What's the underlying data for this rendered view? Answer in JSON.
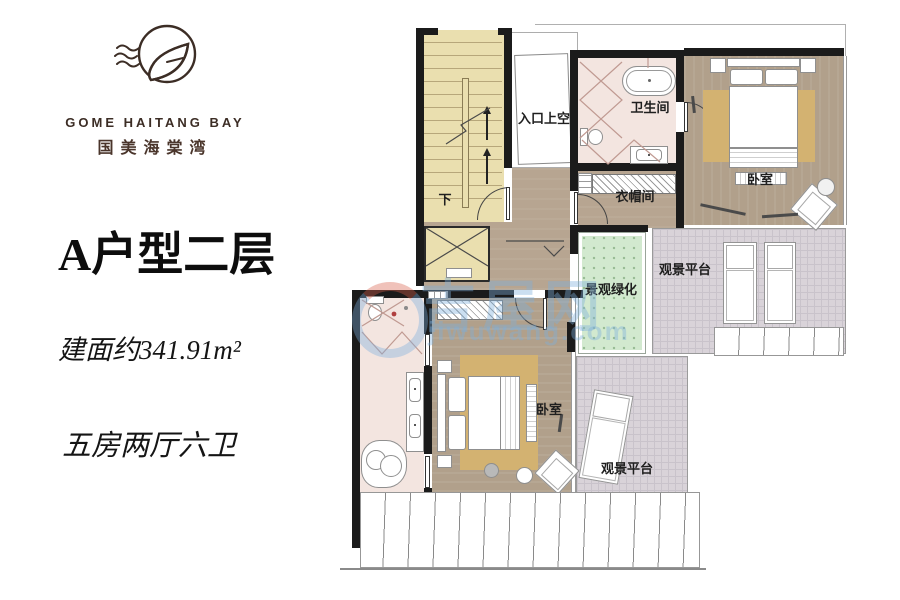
{
  "brand": {
    "logo_en": "GOME HAITANG BAY",
    "logo_cn": "国美海棠湾"
  },
  "unit": {
    "title": "A户型二层",
    "area": "建面约341.91m²",
    "rooms": "五房两厅六卫"
  },
  "plan": {
    "labels": {
      "stairs_down": "下",
      "entry_void": "入口上空",
      "bathroom_top": "卫生间",
      "wardrobe": "衣帽间",
      "bedroom_top": "卧室",
      "green": "景观绿化",
      "deck_top": "观景平台",
      "bedroom_bottom": "卧室",
      "deck_bottom": "观景平台"
    },
    "colors": {
      "wall": "#1b1b1b",
      "stair_floor": "#eadfaf",
      "bath_floor": "#f3e5e0",
      "wood_floor": "#b1a08b",
      "rug": "#d3b271",
      "green_area": "#d2e9cf",
      "deck_tile": "#d9d3d9",
      "brand_text": "#3c2d25"
    }
  },
  "watermark": {
    "name": "吉屋网",
    "domain": "jiwuwang.com"
  }
}
